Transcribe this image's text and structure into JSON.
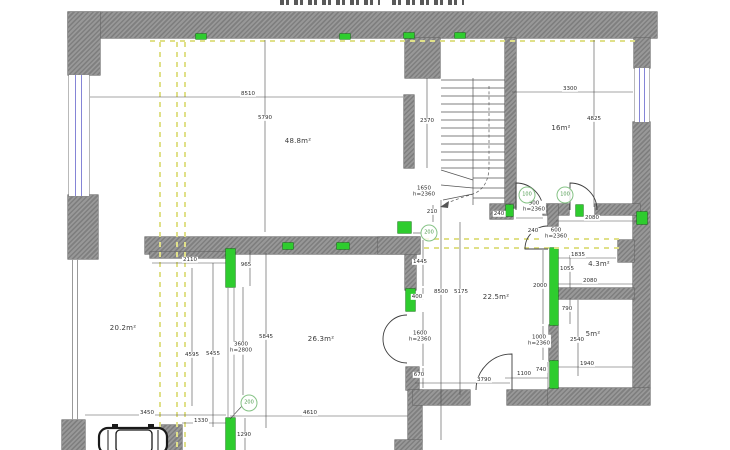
{
  "colors": {
    "wall_hatch_dark": "#7f7f7f",
    "wall_hatch_light": "#989898",
    "new_wall_green": "#2ecc2e",
    "demolition_yellow": "#e0e089",
    "window_blue": "#8585d6",
    "dimension_line": "#4a4a4a",
    "dimension_text": "#2e2e2e",
    "marker_green": "#4e9a4e"
  },
  "rooms": [
    {
      "label": "48.8m²",
      "x": 298,
      "y": 141
    },
    {
      "label": "16m²",
      "x": 561,
      "y": 128
    },
    {
      "label": "20.2m²",
      "x": 123,
      "y": 328
    },
    {
      "label": "26.3m²",
      "x": 321,
      "y": 339
    },
    {
      "label": "22.5m²",
      "x": 496,
      "y": 297
    },
    {
      "label": "4.3m²",
      "x": 599,
      "y": 264
    },
    {
      "label": "5m²",
      "x": 593,
      "y": 334
    }
  ],
  "dimensions": [
    {
      "t": "8510",
      "x": 248,
      "y": 94
    },
    {
      "t": "5790",
      "x": 265,
      "y": 118
    },
    {
      "t": "2370",
      "x": 427,
      "y": 121
    },
    {
      "t": "1650",
      "t2": "h=2360",
      "x": 424,
      "y": 192
    },
    {
      "t": "3300",
      "x": 570,
      "y": 89
    },
    {
      "t": "4825",
      "x": 594,
      "y": 119
    },
    {
      "t": "240",
      "x": 499,
      "y": 214
    },
    {
      "t": "900",
      "t2": "h=2360",
      "x": 534,
      "y": 207
    },
    {
      "t": "240",
      "x": 533,
      "y": 231
    },
    {
      "t": "600",
      "t2": "h=2360",
      "x": 556,
      "y": 234
    },
    {
      "t": "2080",
      "x": 592,
      "y": 218
    },
    {
      "t": "1835",
      "x": 578,
      "y": 255
    },
    {
      "t": "1055",
      "x": 567,
      "y": 269
    },
    {
      "t": "2000",
      "x": 540,
      "y": 286
    },
    {
      "t": "2080",
      "x": 590,
      "y": 281
    },
    {
      "t": "790",
      "x": 567,
      "y": 309
    },
    {
      "t": "1000",
      "t2": "h=2360",
      "x": 539,
      "y": 341
    },
    {
      "t": "740",
      "x": 541,
      "y": 370
    },
    {
      "t": "2540",
      "x": 577,
      "y": 340
    },
    {
      "t": "1940",
      "x": 587,
      "y": 364
    },
    {
      "t": "210",
      "x": 432,
      "y": 212
    },
    {
      "t": "1445",
      "x": 420,
      "y": 262
    },
    {
      "t": "400",
      "x": 417,
      "y": 297
    },
    {
      "t": "1600",
      "t2": "h=2360",
      "x": 420,
      "y": 337
    },
    {
      "t": "670",
      "x": 419,
      "y": 375
    },
    {
      "t": "8500",
      "x": 441,
      "y": 292
    },
    {
      "t": "5175",
      "x": 461,
      "y": 292
    },
    {
      "t": "3790",
      "x": 484,
      "y": 380
    },
    {
      "t": "1100",
      "x": 524,
      "y": 374
    },
    {
      "t": "2110",
      "x": 190,
      "y": 260
    },
    {
      "t": "965",
      "x": 246,
      "y": 265
    },
    {
      "t": "4595",
      "x": 192,
      "y": 355
    },
    {
      "t": "5455",
      "x": 213,
      "y": 354
    },
    {
      "t": "3600",
      "t2": "h=2800",
      "x": 241,
      "y": 348
    },
    {
      "t": "5845",
      "x": 266,
      "y": 337
    },
    {
      "t": "4610",
      "x": 310,
      "y": 413
    },
    {
      "t": "3450",
      "x": 147,
      "y": 413
    },
    {
      "t": "1330",
      "x": 201,
      "y": 421
    },
    {
      "t": "1290",
      "x": 244,
      "y": 435
    }
  ],
  "markers": [
    {
      "t": "100",
      "x": 527,
      "y": 195
    },
    {
      "t": "100",
      "x": 565,
      "y": 195
    },
    {
      "t": "200",
      "x": 429,
      "y": 233
    },
    {
      "t": "200",
      "x": 249,
      "y": 403
    }
  ]
}
